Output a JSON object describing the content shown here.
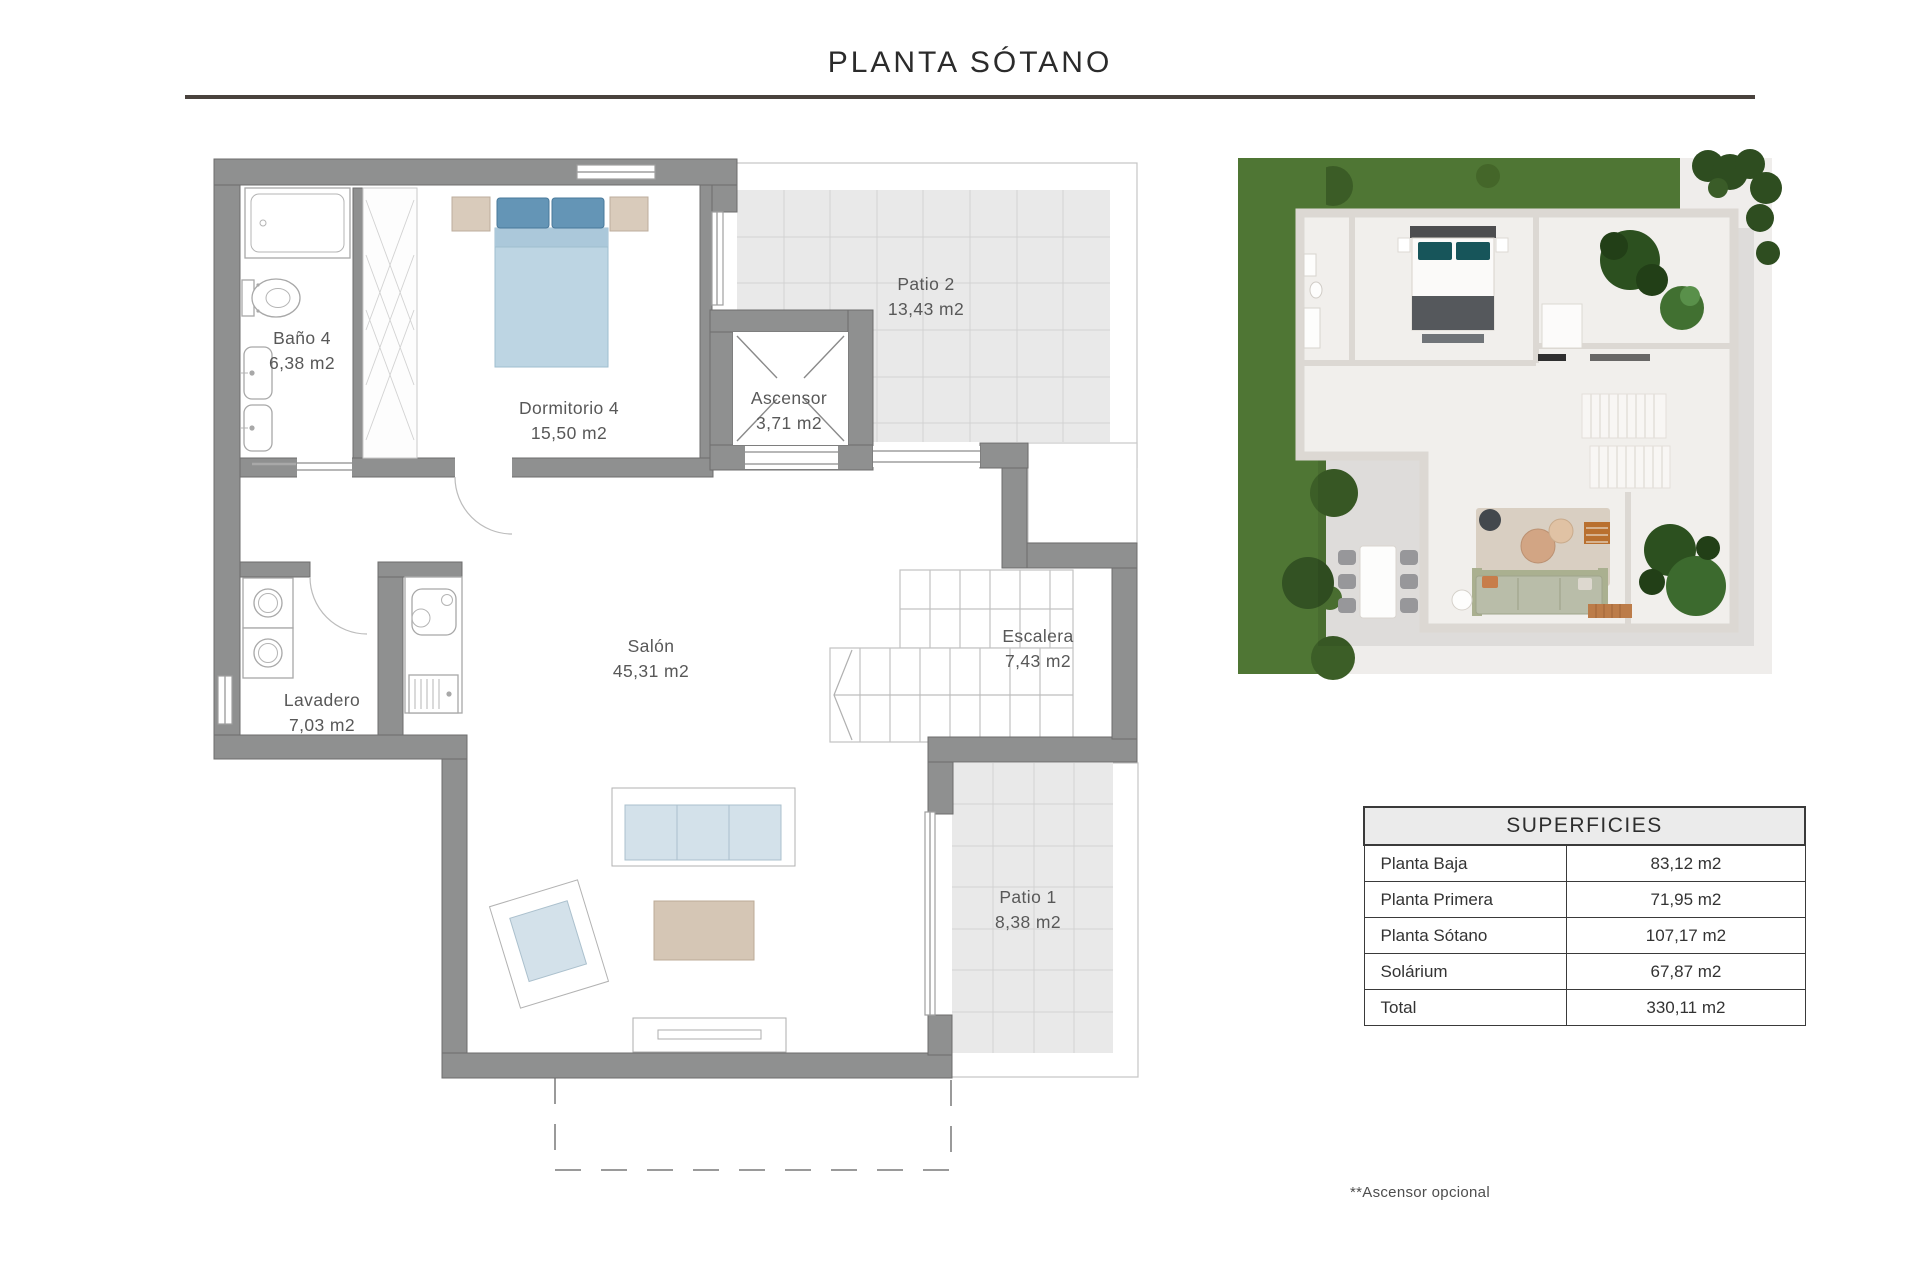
{
  "title": "PLANTA SÓTANO",
  "plan": {
    "rooms": [
      {
        "name": "Baño 4",
        "area": "6,38 m2"
      },
      {
        "name": "Dormitorio 4",
        "area": "15,50 m2"
      },
      {
        "name": "Ascensor",
        "area": "3,71 m2"
      },
      {
        "name": "Patio 2",
        "area": "13,43 m2"
      },
      {
        "name": "Lavadero",
        "area": "7,03 m2"
      },
      {
        "name": "Salón",
        "area": "45,31 m2"
      },
      {
        "name": "Escalera",
        "area": "7,43 m2"
      },
      {
        "name": "Patio 1",
        "area": "8,38 m2"
      }
    ]
  },
  "surfaces_table": {
    "header": "SUPERFICIES",
    "rows": [
      {
        "label": "Planta Baja",
        "value": "83,12 m2"
      },
      {
        "label": "Planta Primera",
        "value": "71,95 m2"
      },
      {
        "label": "Planta Sótano",
        "value": "107,17 m2"
      },
      {
        "label": "Solárium",
        "value": "67,87 m2"
      },
      {
        "label": "Total",
        "value": "330,11 m2"
      }
    ]
  },
  "footnote": "**Ascensor opcional",
  "colors": {
    "wall_gray": "#8f9090",
    "tile_gray": "#e9e9e9",
    "sofa_blue": "#d3e1ea",
    "bed_blue": "#bdd5e3",
    "pillow_blue": "#6495b6",
    "beige": "#d5c6b5",
    "grass_green": "#4f7634",
    "table_border": "#3a3a3a",
    "underline": "#49423d"
  }
}
